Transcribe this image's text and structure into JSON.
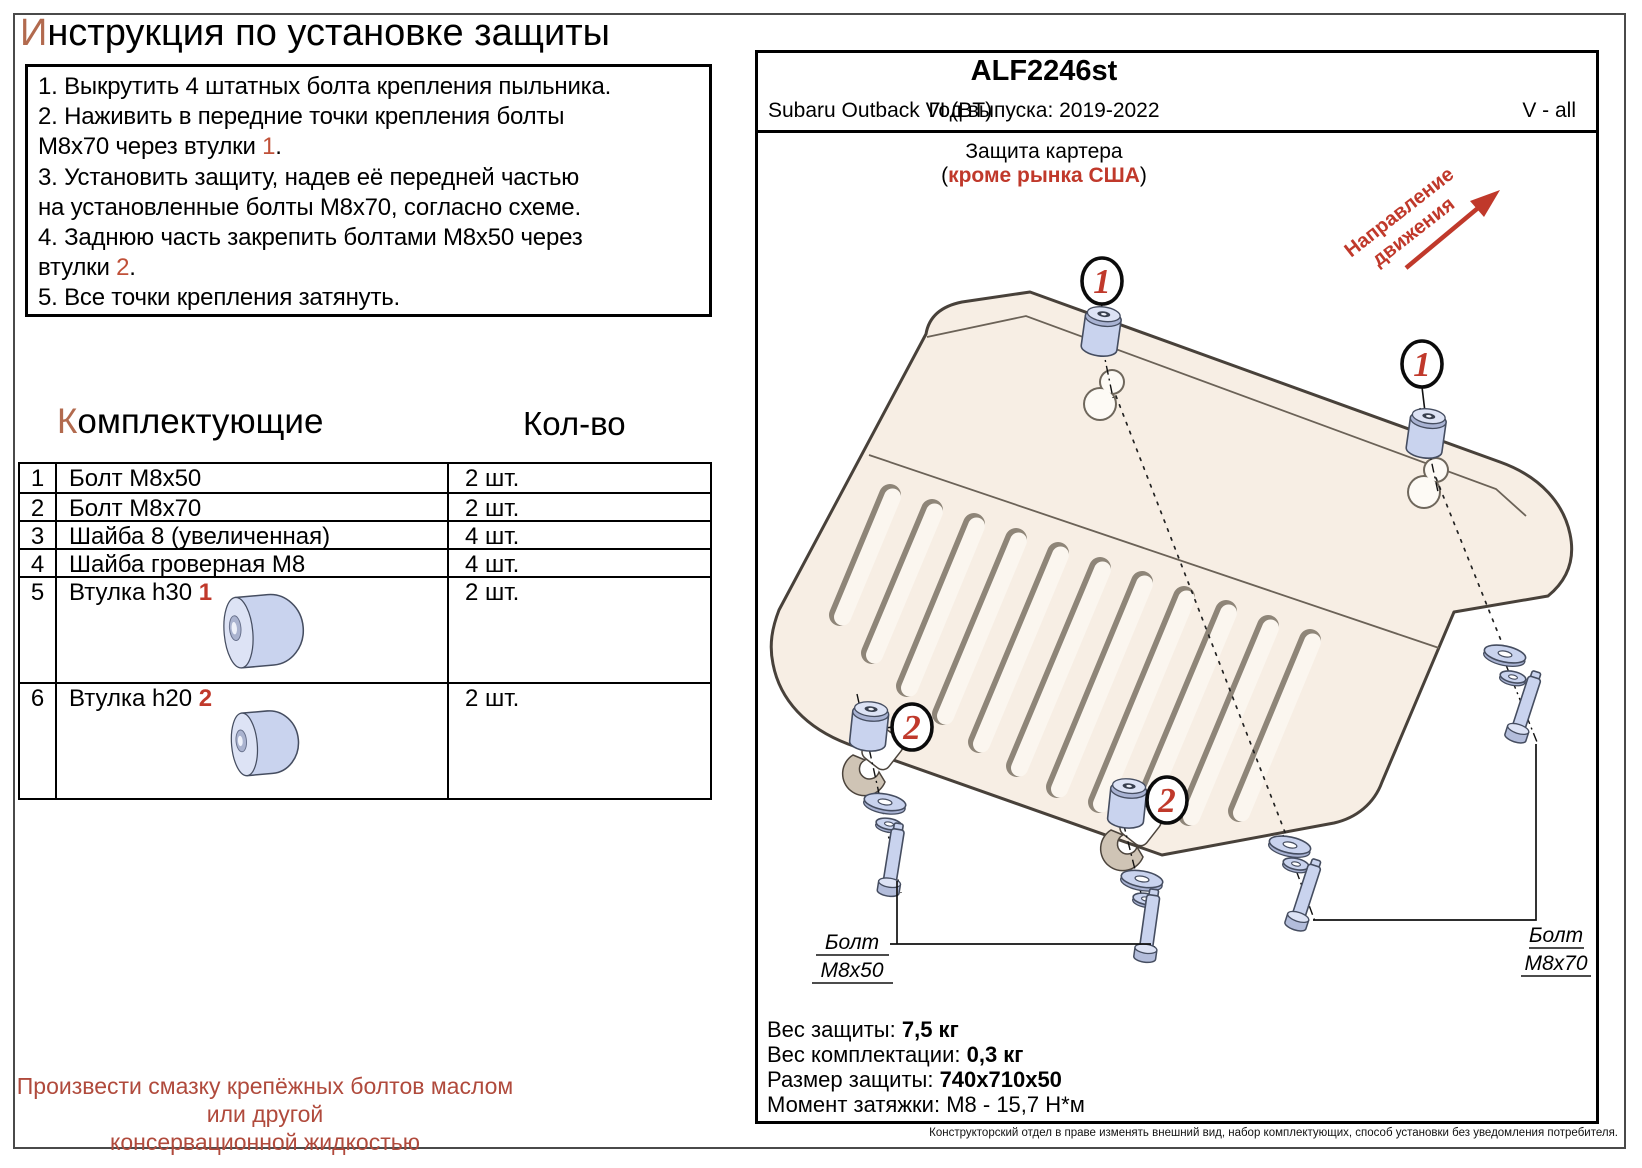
{
  "colors": {
    "accent_red": "#c0392b",
    "ref_red": "#c05038",
    "title_letter": "#b26a4e",
    "note_red": "#b04a3c"
  },
  "title": {
    "first_letter": "И",
    "rest": "нструкция по установке защиты"
  },
  "instructions": [
    {
      "lines": [
        {
          "t": "1. Выкрутить 4 штатных болта крепления пыльника."
        }
      ]
    },
    {
      "lines": [
        {
          "t": "2. Наживить в передние точки крепления болты"
        },
        {
          "t": "М8х70 через втулки ",
          "red": "1",
          "post": "."
        }
      ]
    },
    {
      "lines": [
        {
          "t": "3. Установить защиту, надев её передней частью"
        },
        {
          "t": "на установленные болты М8х70, согласно схеме."
        }
      ]
    },
    {
      "lines": [
        {
          "t": "4. Заднюю часть закрепить болтами М8х50 через"
        },
        {
          "t": "втулки ",
          "red": "2",
          "post": "."
        }
      ]
    },
    {
      "lines": [
        {
          "t": "5. Все точки крепления затянуть."
        }
      ]
    }
  ],
  "components": {
    "title_first_letter": "К",
    "title_rest": "омплектующие",
    "qty_header": "Кол-во",
    "rows": [
      {
        "num": "1",
        "name": "Болт М8х50",
        "qty": "2 шт."
      },
      {
        "num": "2",
        "name": "Болт М8х70",
        "qty": "2 шт."
      },
      {
        "num": "3",
        "name": "Шайба 8 (увеличенная)",
        "qty": "4 шт."
      },
      {
        "num": "4",
        "name": "Шайба гроверная М8",
        "qty": "4 шт."
      },
      {
        "num": "5",
        "name": "Втулка h30 ",
        "ref": "1",
        "qty": "2 шт.",
        "img": "bushing-tall"
      },
      {
        "num": "6",
        "name": "Втулка h20 ",
        "ref": "2",
        "qty": "2 шт.",
        "img": "bushing-short"
      }
    ]
  },
  "note_line1": "Произвести смазку крепёжных болтов маслом или другой",
  "note_line2": "консервационной жидкостью",
  "panel": {
    "part_number": "ALF2246st",
    "vehicle": "Subaru Outback VI (BT)",
    "year": "Год выпуска: 2019-2022",
    "engine": "V - all",
    "product": "Защита картера",
    "market_prefix": "(",
    "market": "кроме рынка США",
    "market_suffix": ")",
    "direction_line1": "Направление",
    "direction_line2": "движения",
    "callout_front": "1",
    "callout_rear": "2",
    "bolt_label_left_line1": "Болт",
    "bolt_label_left_line2": "М8х50",
    "bolt_label_right_line1": "Болт",
    "bolt_label_right_line2": "М8х70",
    "specs": [
      {
        "label": "Вес защиты: ",
        "value": "7,5 кг",
        "bold": true
      },
      {
        "label": "Вес комплектации: ",
        "value": "0,3 кг",
        "bold": true
      },
      {
        "label": "Размер защиты: ",
        "value": "740х710х50",
        "bold": true
      },
      {
        "label": "Момент затяжки: ",
        "value": "М8 - 15,7 Н*м",
        "bold": false
      }
    ],
    "disclaimer": "Конструкторский отдел в праве изменять внешний вид, набор комплектующих, способ установки без уведомления потребителя."
  }
}
